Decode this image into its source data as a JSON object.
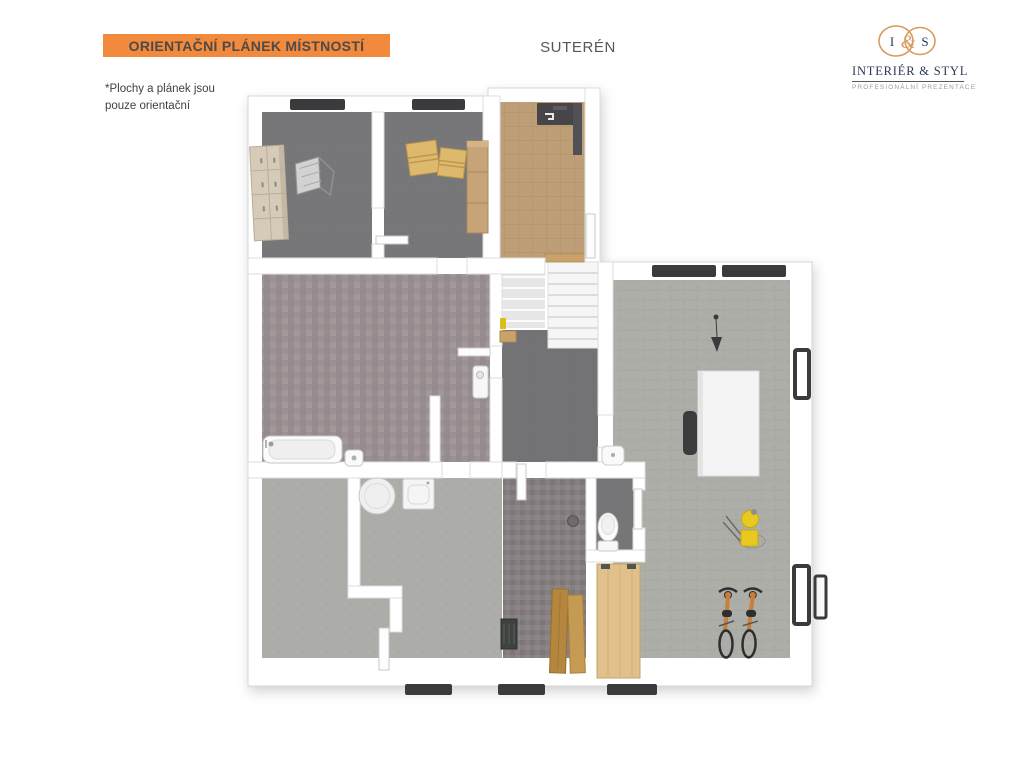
{
  "header": {
    "banner": {
      "label": "ORIENTAČNÍ PLÁNEK MÍSTNOSTÍ",
      "bg": "#F28A3E",
      "text_color": "#4D4A48"
    },
    "floor_title": "SUTERÉN",
    "disclaimer_line1": "*Plochy a plánek jsou",
    "disclaimer_line2": "pouze orientační"
  },
  "logo": {
    "monogram_left": "I",
    "monogram_amp": "&",
    "monogram_right": "S",
    "name": "INTERIÉR & STYL",
    "tagline": "PROFESIONÁLNÍ PREZENTACE",
    "accent_color": "#D89B5D",
    "navy_color": "#2B3A55",
    "tagline_color": "#9B9B9B"
  },
  "floorplan": {
    "colors": {
      "wall": "#FFFFFF",
      "wall_stroke": "#D7D7D7",
      "window": "#3B3B3D",
      "storage_floor": "#77777A",
      "hall_floor": "#BD9E77",
      "bathroom_floor": "#9D9295",
      "corridor_floor": "#737376",
      "utility_floor": "#ACACA9",
      "laundry_floor": "#878082",
      "wc_floor": "#767679",
      "gym_floor": "#AEAEA9",
      "wood_light": "#D6CBB9",
      "wood_tan": "#DDB96E",
      "wood_mid": "#C7A478",
      "wood_plank": "#B5873E",
      "wood_panel": "#E0C18B",
      "bike_frame": "#C87F3C",
      "accent_yellow": "#E8C91F"
    }
  }
}
